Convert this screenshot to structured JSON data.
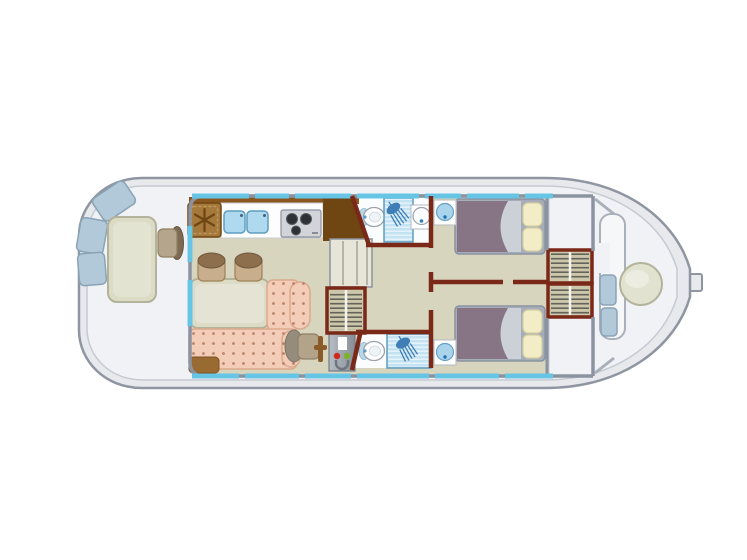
{
  "image": {
    "title": "Houseboat deck floor plan",
    "width": 747,
    "height": 560
  },
  "palette": {
    "hull": "#e8e9ed",
    "hullStroke": "#8f96a1",
    "deck": "#f1f2f5",
    "deckStroke": "#c6cad1",
    "floor": "#d8d5bf",
    "wallGray": "#8b93a0",
    "window": "#66c5e5",
    "maroon": "#7a2817",
    "wood": "#8a571e",
    "woodDark": "#6f4612",
    "fridge": "#a5793c",
    "fridgeDash": "#c49a5e",
    "sinkBlue": "#aed9ee",
    "sinkStroke": "#5f9dc0",
    "stove": "#d2d4d9",
    "burner": "#2e3136",
    "showerBg": "#c3e2f2",
    "showerIcon": "#3f7fb5",
    "basinBlue": "#a9d4ec",
    "mattress": "#877585",
    "sheet": "#ccd0d7",
    "pillow": "#f2edc6",
    "pillowStroke": "#d6cf9f",
    "bedFrame": "#a6adb9",
    "sofa": "#f4cdb8",
    "sofaDot": "#b9846b",
    "sofaStroke": "#dba98c",
    "tableFill": "#dcdbc6",
    "tableStroke": "#b3b29a",
    "stoolSeat": "#c8ae8c",
    "stoolBack": "#8d6f4e",
    "cushion": "#b2c9da",
    "cushionStroke": "#8aa3b5",
    "red": "#cf2a1d",
    "green": "#7fb22a",
    "stairFill": "#e7e5d8",
    "stairLine": "#a9a89a",
    "wardrobeBg": "#ccc6ab",
    "wardrobeStripe": "#63635a",
    "benchFill": "#f6f7f9",
    "benchStroke": "#a9b0ba",
    "sternTable": "#e2e2d0",
    "step": "#9a6a33"
  },
  "inventory": {
    "bow_deck": [
      "three-seat-cushions",
      "deck-table",
      "deck-chair"
    ],
    "galley": [
      "fridge-with-snowflake",
      "double-sink",
      "three-burner-stove",
      "worktop"
    ],
    "saloon": [
      "dinette-table",
      "two-stools",
      "l-shaped-dotted-sofa",
      "helm-seat",
      "steering-lever",
      "control-panel-red-green",
      "companionway-stairs",
      "wardrobe",
      "entry-step"
    ],
    "bathrooms": [
      "toilet",
      "shower",
      "washbasin"
    ],
    "aft_cabins": [
      "double-bed-with-two-pillows",
      "corner-washbasin",
      "hanging-wardrobes"
    ],
    "stern_deck": [
      "c-bench-with-blue-cushions",
      "round-table",
      "tiller"
    ]
  }
}
